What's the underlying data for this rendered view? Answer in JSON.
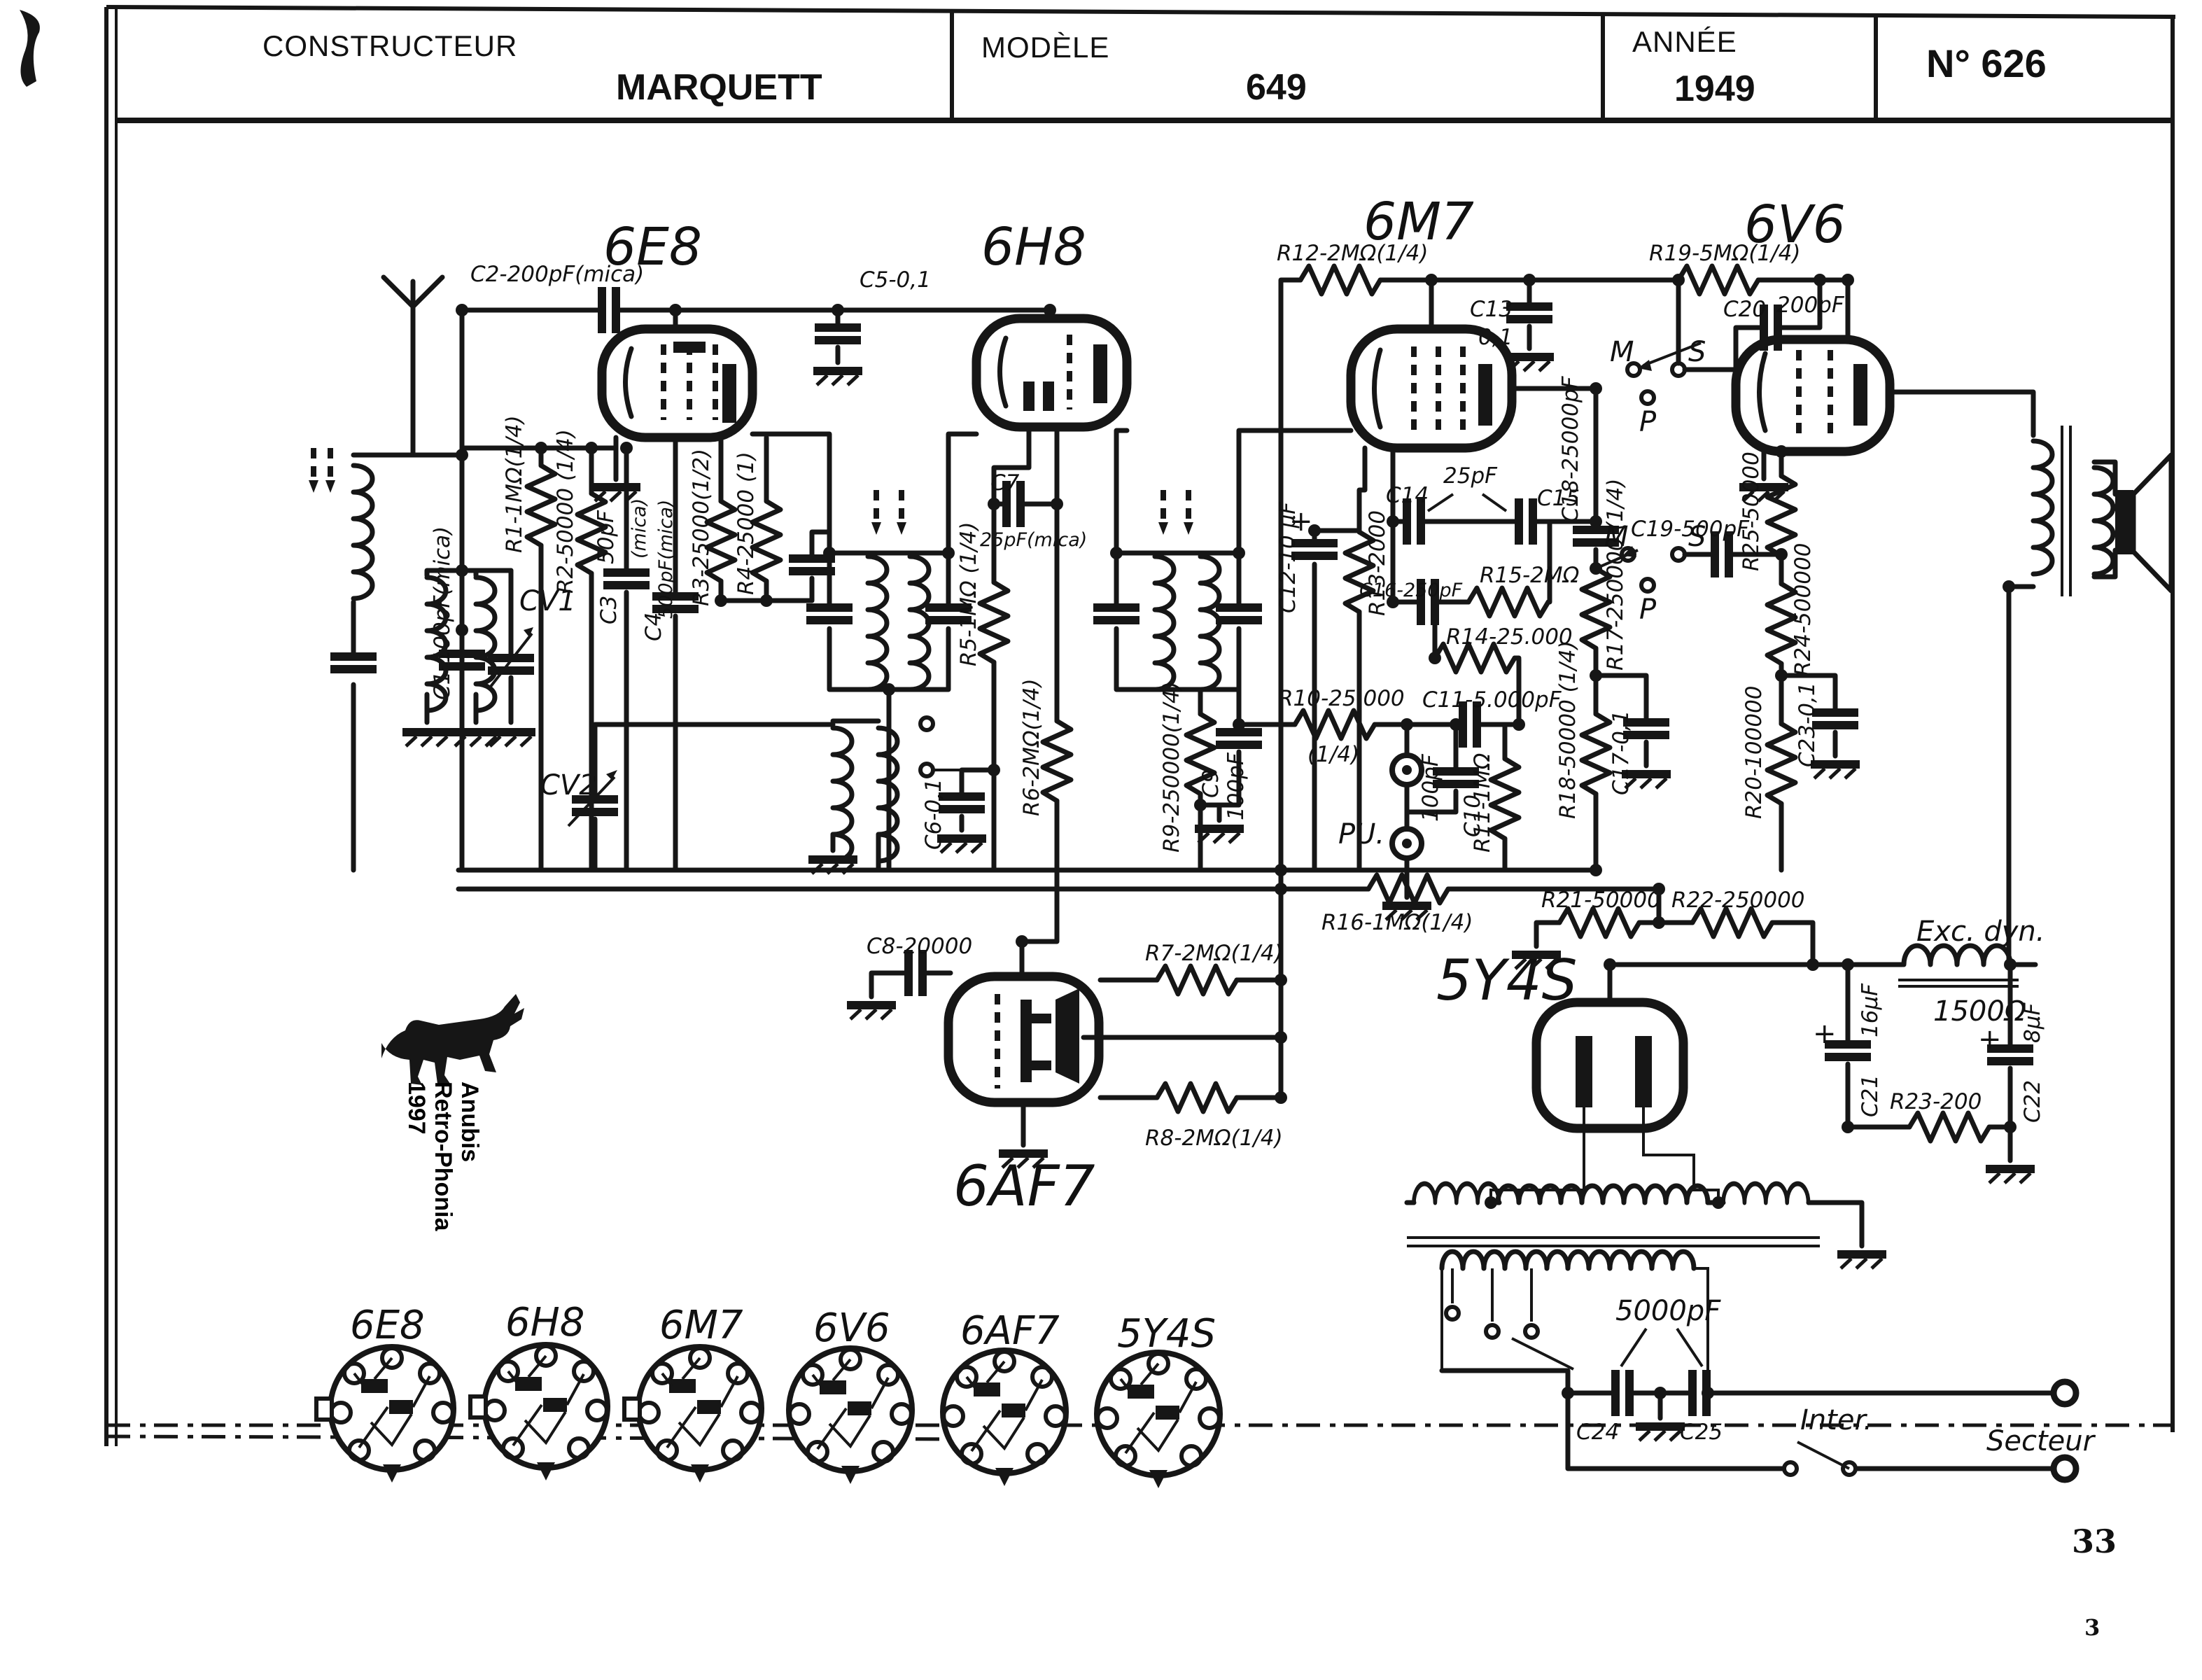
{
  "header": {
    "constructeur_label": "CONSTRUCTEUR",
    "constructeur": "MARQUETT",
    "modele_label": "MODÈLE",
    "modele": "649",
    "annee_label": "ANNÉE",
    "annee": "1949",
    "numero": "N° 626"
  },
  "tube_titles": {
    "v1": "6E8",
    "v2": "6H8",
    "v3": "6M7",
    "v4": "6V6",
    "v5": "6AF7",
    "v6": "5Y4S"
  },
  "sockets": [
    "6E8",
    "6H8",
    "6M7",
    "6V6",
    "6AF7",
    "5Y4S"
  ],
  "labels": {
    "c1": "C1-100pF(mica)",
    "c2": "C2-200pF(mica)",
    "c3": "C3",
    "c3_val": "50pF",
    "c3_note": "(mica)",
    "c4": "C4",
    "c4_val": "500pF(mica)",
    "c5": "C5-0,1",
    "c6": "C6-0,1",
    "c7": "C7",
    "c7_val": "25pF(mica)",
    "c8": "C8-20000",
    "c9": "C9",
    "c9_val": "100pF",
    "c10": "C10",
    "c10_val": "100pF",
    "c11": "C11-5.000pF",
    "c12": "C12-10 µF",
    "c13": "C13",
    "c13_val": "0,1",
    "c14": "C14",
    "c14_15_val": "25pF",
    "c15": "C15",
    "c16": "C16-250pF",
    "c17": "C17-0,1",
    "c18": "C18-25000pF",
    "c19": "C19-500pF",
    "c20": "C20",
    "c20_val": "200pF",
    "c21": "C21",
    "c21_val": "16µF",
    "c22": "C22",
    "c22_val": "8µF",
    "c23": "C23-0,1",
    "c24": "C24",
    "c25": "C25",
    "c24_25_val": "5000pF",
    "cv1": "CV1",
    "cv2": "CV2",
    "r1": "R1-1MΩ(1/4)",
    "r2": "R2-50000 (1/4)",
    "r3": "R3-25000(1/2)",
    "r4": "R4-25000 (1)",
    "r5": "R5-1MΩ (1/4)",
    "r6": "R6-2MΩ(1/4)",
    "r7": "R7-2MΩ(1/4)",
    "r8": "R8-2MΩ(1/4)",
    "r9": "R9-250000(1/4)",
    "r10": "R10-25.000",
    "r10_note": "(1/4)",
    "r11": "R11-1MΩ",
    "r12": "R12-2MΩ(1/4)",
    "r13": "R13-2000",
    "r14": "R14-25.000",
    "r15": "R15-2MΩ",
    "r16": "R16-1MΩ(1/4)",
    "r17": "R17-250000 (1/4)",
    "r18": "R18-50000 (1/4)",
    "r19": "R19-5MΩ(1/4)",
    "r20": "R20-100000",
    "r21": "R21-50000",
    "r22": "R22-250000",
    "r23": "R23-200",
    "r24": "R24-500000",
    "r25": "R25-50000",
    "pu": "PU.",
    "exc": "Exc. dyn.",
    "exc_val": "1500Ω",
    "inter": "Inter.",
    "secteur": "Secteur",
    "sw1_m": "M",
    "sw1_s": "S",
    "sw1_p": "P",
    "sw2_m": "M",
    "sw2_s": "S",
    "sw2_p": "P",
    "plus": "+"
  },
  "watermark": {
    "line1": "Anubis",
    "line2": "Retro-Phonia",
    "line3": "1997"
  },
  "page": {
    "num": "33",
    "sub": "3"
  },
  "colors": {
    "ink": "#161616",
    "paper": "#ffffff"
  }
}
